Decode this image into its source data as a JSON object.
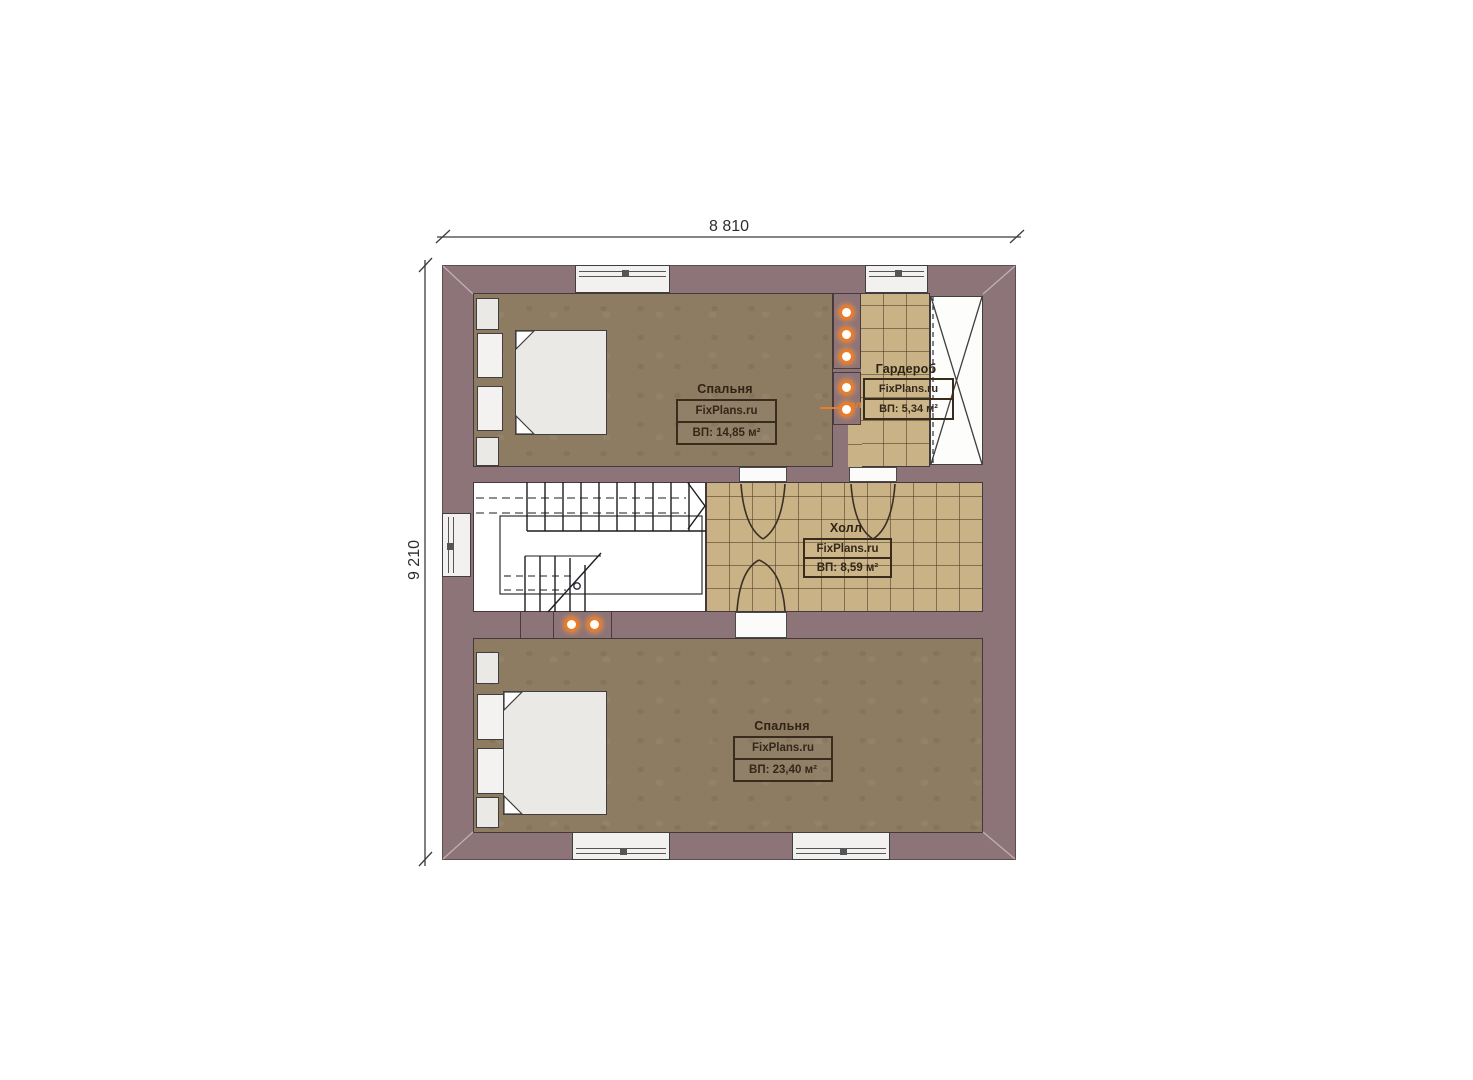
{
  "plan": {
    "dim_width": "8 810",
    "dim_height": "9 210",
    "rooms": [
      {
        "name": "Спальня",
        "brand": "FixPlans.ru",
        "area": "ВП: 14,85 м²"
      },
      {
        "name": "Гардероб",
        "brand": "FixPlans.ru",
        "area": "ВП: 5,34 м²"
      },
      {
        "name": "Холл",
        "brand": "FixPlans.ru",
        "area": "ВП: 8,59 м²"
      },
      {
        "name": "Спальня",
        "brand": "FixPlans.ru",
        "area": "ВП: 23,40 м²"
      }
    ],
    "markers": {
      "electrical": "эл"
    },
    "colors": {
      "wall": "#8d7478",
      "bedroom_floor": "#8d7b62",
      "tile_floor": "#c9b285",
      "accent_orange": "#e87c2a",
      "line": "#3f3f3f"
    }
  }
}
